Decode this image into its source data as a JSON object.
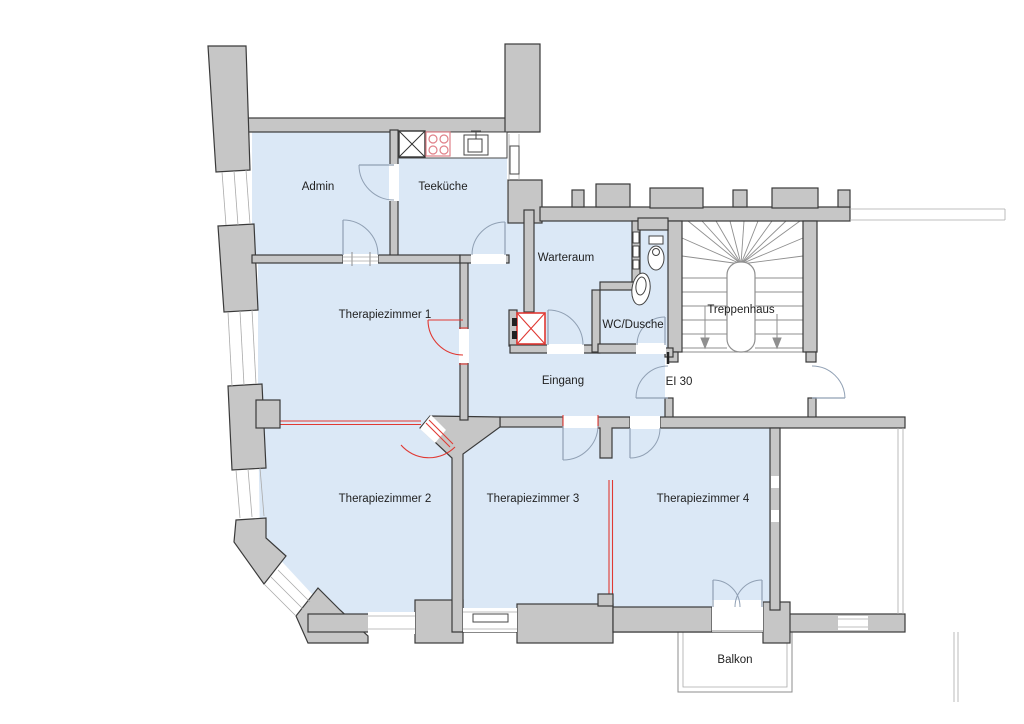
{
  "title": "Grundriss Therapiepraxis",
  "rooms": {
    "admin": {
      "label": "Admin"
    },
    "teekueche": {
      "label": "Teeküche"
    },
    "warteraum": {
      "label": "Warteraum"
    },
    "wc_dusche": {
      "label": "WC/Dusche"
    },
    "therapiezimmer1": {
      "label": "Therapiezimmer 1"
    },
    "eingang": {
      "label": "Eingang"
    },
    "treppenhaus": {
      "label": "Treppenhaus"
    },
    "therapiezimmer2": {
      "label": "Therapiezimmer 2"
    },
    "therapiezimmer3": {
      "label": "Therapiezimmer 3"
    },
    "therapiezimmer4": {
      "label": "Therapiezimmer 4"
    },
    "balkon": {
      "label": "Balkon"
    }
  },
  "annotations": {
    "fire_rating_door": "EI 30"
  },
  "legend_semantics": {
    "blue_fill": "Mietfläche / unit area",
    "red_elements": "new construction elements",
    "gray_fill": "walls"
  },
  "colors": {
    "room_fill": "#dbe8f6",
    "wall_fill": "#c6c6c6",
    "wall_stroke": "#3a3a3a",
    "new_element": "#e03933",
    "door_arc": "#90a0b4"
  }
}
